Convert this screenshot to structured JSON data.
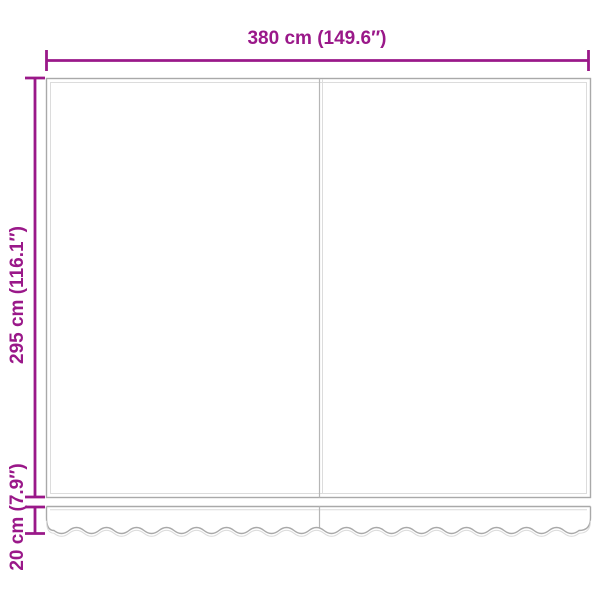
{
  "diagram": {
    "labels": {
      "width": "380 cm (149.6″)",
      "height": "295 cm (116.1″)",
      "valance": "20 cm (7.9″)"
    },
    "colors": {
      "dimension": "#9a1889",
      "outline": "#a9a9a9",
      "outline_light": "#dcdcdc",
      "background": "#ffffff"
    }
  }
}
